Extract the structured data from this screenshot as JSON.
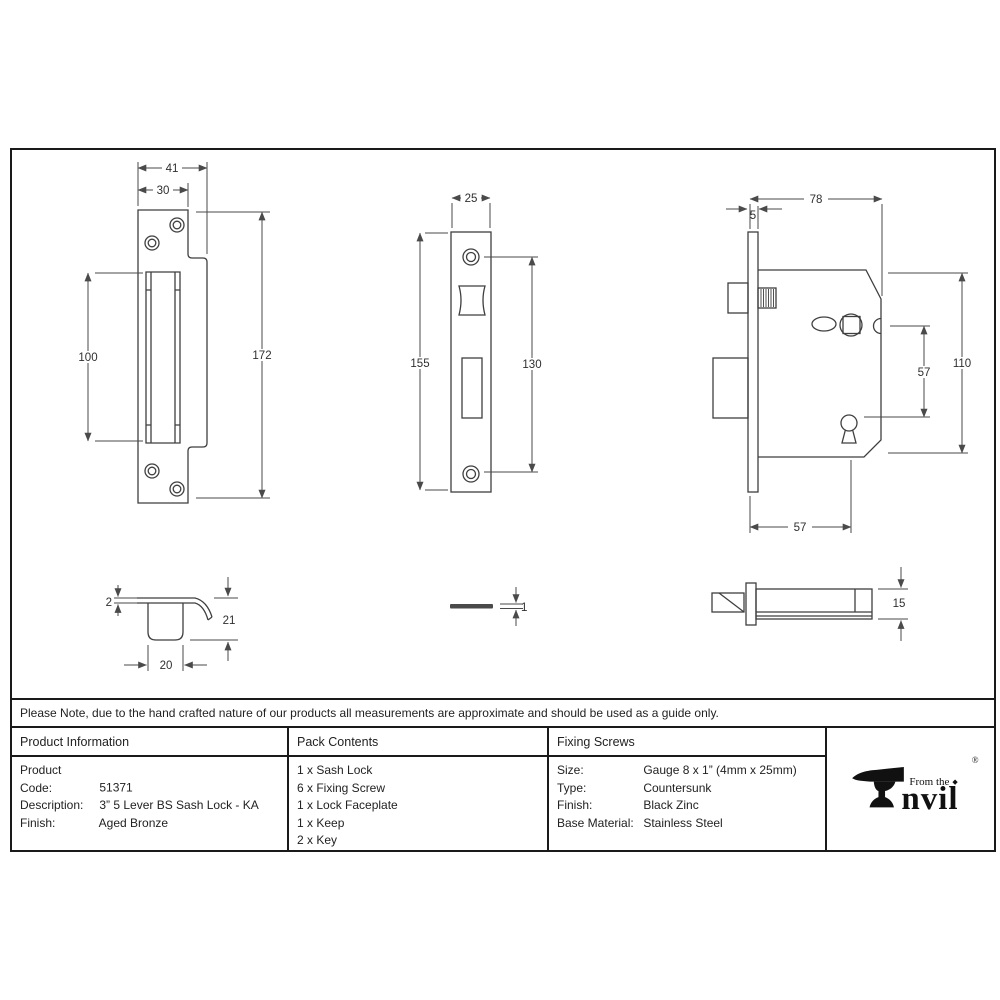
{
  "note": "Please Note, due to the hand crafted nature of our products all measurements are approximate and should be used as a guide only.",
  "drawings": {
    "keep_front": {
      "dims": {
        "outer_width": "41",
        "inner_width": "30",
        "slot_height": "100",
        "plate_height": "172"
      }
    },
    "faceplate_front": {
      "dims": {
        "width": "25",
        "plate_height": "155",
        "hole_spacing": "130"
      }
    },
    "lock_body_side": {
      "dims": {
        "case_depth": "78",
        "faceplate_thickness": "5",
        "case_height": "110",
        "spindle_to_keyhole": "57",
        "backset": "57"
      }
    },
    "keep_profile": {
      "dims": {
        "plate_thickness": "2",
        "box_depth": "21",
        "box_width": "20"
      }
    },
    "faceplate_profile": {
      "dims": {
        "thickness": "1"
      }
    },
    "lock_body_top": {
      "dims": {
        "case_thickness": "15"
      }
    }
  },
  "table": {
    "product_information": {
      "header": "Product Information",
      "rows": [
        {
          "label": "Product Code:",
          "value": "51371"
        },
        {
          "label": "Description:",
          "value": "3” 5 Lever BS Sash Lock - KA"
        },
        {
          "label": "Finish:",
          "value": "Aged Bronze"
        }
      ]
    },
    "pack_contents": {
      "header": "Pack Contents",
      "items": [
        "1 x Sash Lock",
        "6 x Fixing Screw",
        "1 x Lock Faceplate",
        "1 x Keep",
        "2 x Key"
      ]
    },
    "fixing_screws": {
      "header": "Fixing Screws",
      "rows": [
        {
          "label": "Size:",
          "value": "Gauge 8 x 1” (4mm x 25mm)"
        },
        {
          "label": "Type:",
          "value": "Countersunk"
        },
        {
          "label": "Finish:",
          "value": "Black Zinc"
        },
        {
          "label": "Base Material:",
          "value": "Stainless Steel"
        }
      ]
    }
  },
  "brand": {
    "prefix": "From the",
    "suffix": "nvil",
    "registered": "®",
    "diamond": "◆"
  }
}
